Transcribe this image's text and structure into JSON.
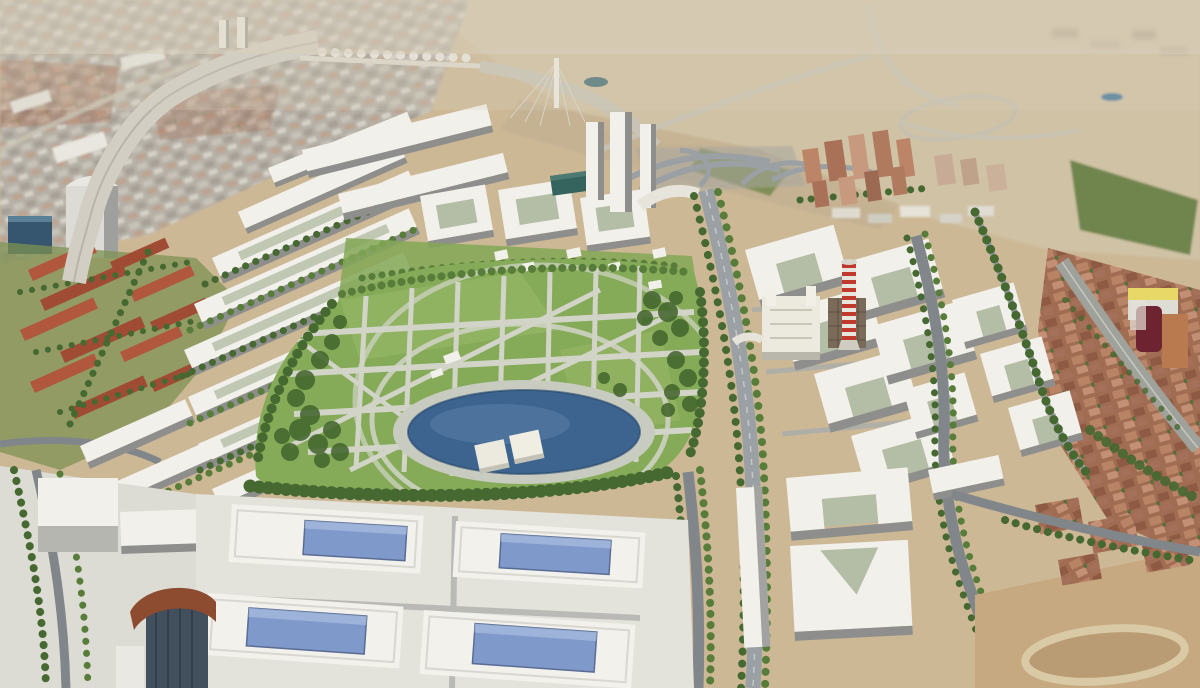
{
  "image": {
    "kind": "aerial architectural rendering (photomontage)",
    "subject": "masterplan of a new urban district with central linear park inserted into an existing city"
  },
  "scene": {
    "elements": [
      "existing-city-terracotta-blocks",
      "railway-corridor-with-viaduct",
      "twin-highrise-towers",
      "cable-stayed-bridge-pylon",
      "highway-interchange",
      "new-district-white-perimeter-blocks",
      "central-park-with-path-grid",
      "circular-pond-with-twin-piers",
      "tree-lined-boulevards",
      "red-white-striped-water-tower",
      "historic-white-building",
      "exhibition-halls-with-blue-glass-roofs",
      "dark-tower-with-rust-canopy",
      "dirt-lot-with-oval-track"
    ]
  },
  "palette": {
    "plains_tan": "#cdb896",
    "haze": "#d9d0bc",
    "park_grass": "#85ab58",
    "pond_blue": "#3c648f",
    "skylight_blue": "#8099cb",
    "building_white": "#f2f1ec",
    "road_grey": "#9aa0a3",
    "plaza": "#dcdcd4",
    "tower_dark": "#42505e",
    "canopy_rust": "#8d4b30",
    "dirt_tan": "#c6a981",
    "tree_green": "#466831",
    "brick": "#ad7659",
    "terracotta_roof": "#b0573d",
    "stripe_red": "#c03a2b"
  }
}
